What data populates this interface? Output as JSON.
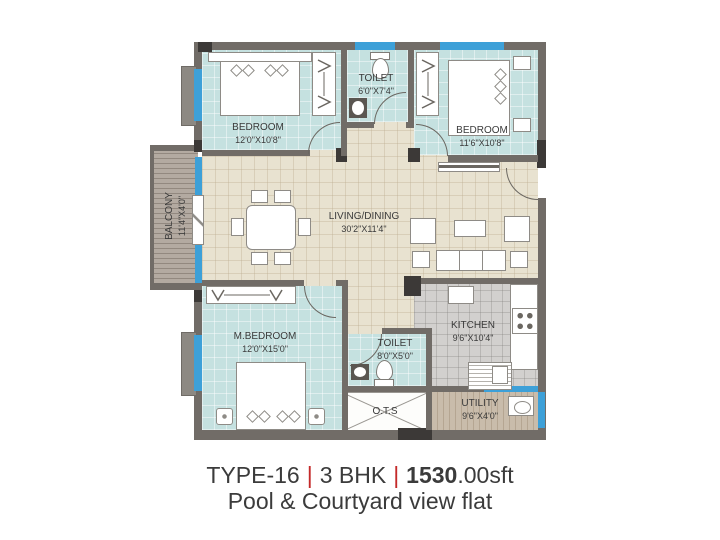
{
  "caption": {
    "type": "TYPE-16",
    "sep": "|",
    "config": "3 BHK",
    "sep2": "|",
    "area_bold": "1530",
    "area_rest": ".00sft",
    "line2": "Pool & Courtyard view flat"
  },
  "rooms": {
    "bedroom1": {
      "name": "BEDROOM",
      "size": "12'0\"X10'8\""
    },
    "toilet1": {
      "name": "TOILET",
      "size": "6'0\"X7'4\""
    },
    "bedroom2": {
      "name": "BEDROOM",
      "size": "11'6\"X10'8\""
    },
    "balcony": {
      "name": "BALCONY",
      "size": "11'4\"X4'0\""
    },
    "living": {
      "name": "LIVING/DINING",
      "size": "30'2\"X11'4\""
    },
    "mbedroom": {
      "name": "M.BEDROOM",
      "size": "12'0\"X15'0\""
    },
    "toilet2": {
      "name": "TOILET",
      "size": "8'0\"X5'0\""
    },
    "ots": {
      "name": "O.T.S"
    },
    "kitchen": {
      "name": "KITCHEN",
      "size": "9'6\"X10'4\""
    },
    "utility": {
      "name": "UTILITY",
      "size": "9'6\"X4'0\""
    }
  },
  "colors": {
    "wall": "#716c67",
    "window": "#3da0d8",
    "teal": "#c5e1e0",
    "beige": "#e8e2d0",
    "kitchen": "#d2d0ce",
    "wood-balcony": "#b3aaa1",
    "wood-utility": "#c9bcab",
    "accent-red": "#c42a2a"
  }
}
